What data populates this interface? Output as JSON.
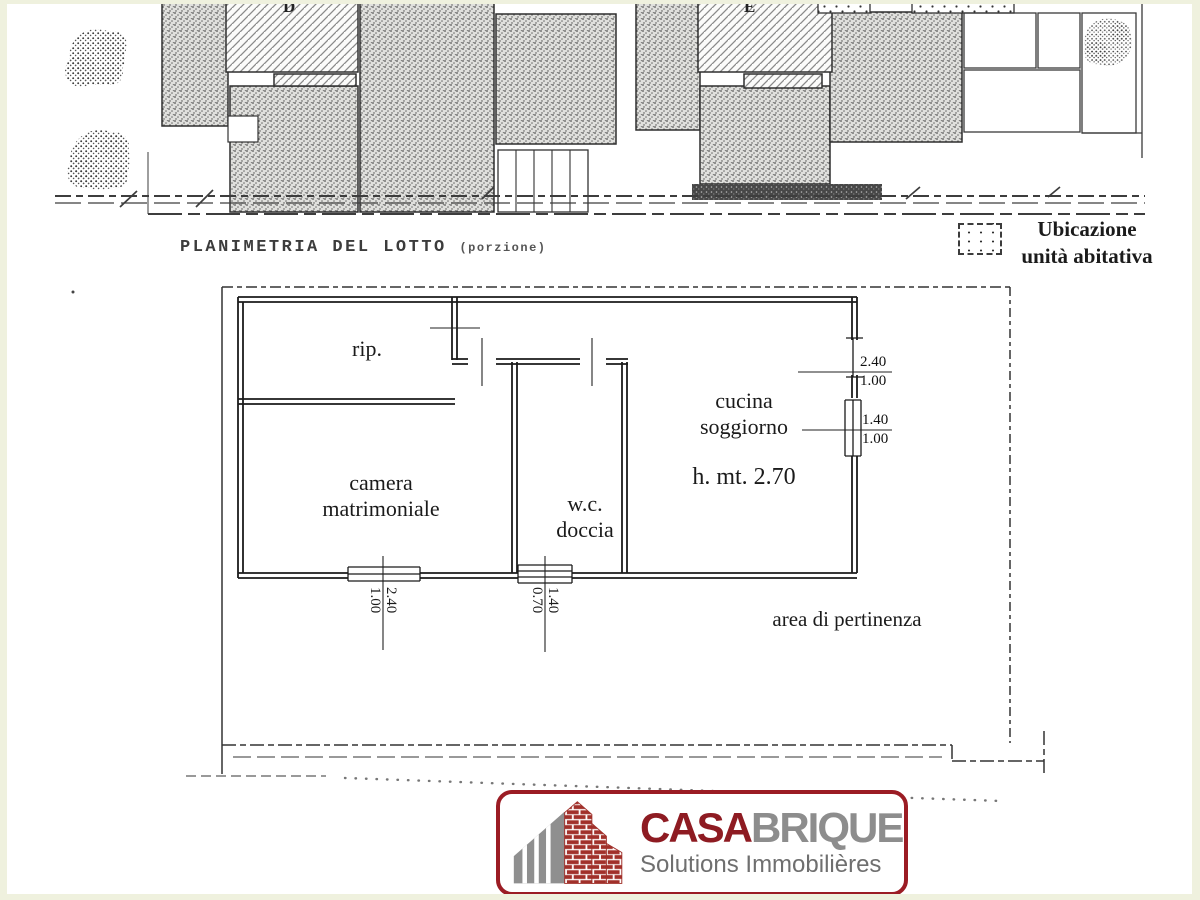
{
  "site_plan": {
    "title": "PLANIMETRIA DEL LOTTO",
    "title_suffix": "(porzione)",
    "building_d_label": "D",
    "building_e_label": "E",
    "legend": {
      "line1": "Ubicazione",
      "line2": "unità abitativa"
    }
  },
  "floor_plan": {
    "rooms": {
      "storage": "rip.",
      "bedroom_line1": "camera",
      "bedroom_line2": "matrimoniale",
      "wc_line1": "w.c.",
      "wc_line2": "doccia",
      "kitchen_line1": "cucina",
      "kitchen_line2": "soggiorno",
      "ceiling_height": "h. mt. 2.70",
      "outdoor_area": "area di pertinenza"
    },
    "openings": [
      {
        "id": "right-upper-window",
        "top": "2.40",
        "bottom": "1.00"
      },
      {
        "id": "right-lower-window",
        "top": "1.40",
        "bottom": "1.00"
      },
      {
        "id": "bottom-left-window",
        "top": "2.40",
        "bottom": "1.00"
      },
      {
        "id": "bottom-right-window",
        "top": "1.40",
        "bottom": "0.70"
      }
    ]
  },
  "logo": {
    "brand_part1": "CASA",
    "brand_part2": "BRIQUE",
    "tagline": "Solutions Immobilières",
    "colors": {
      "brand_red": "#8e1b22",
      "brand_gray": "#8d8d8d",
      "border_red": "#9b1c24",
      "brick": "#a1302a"
    }
  }
}
